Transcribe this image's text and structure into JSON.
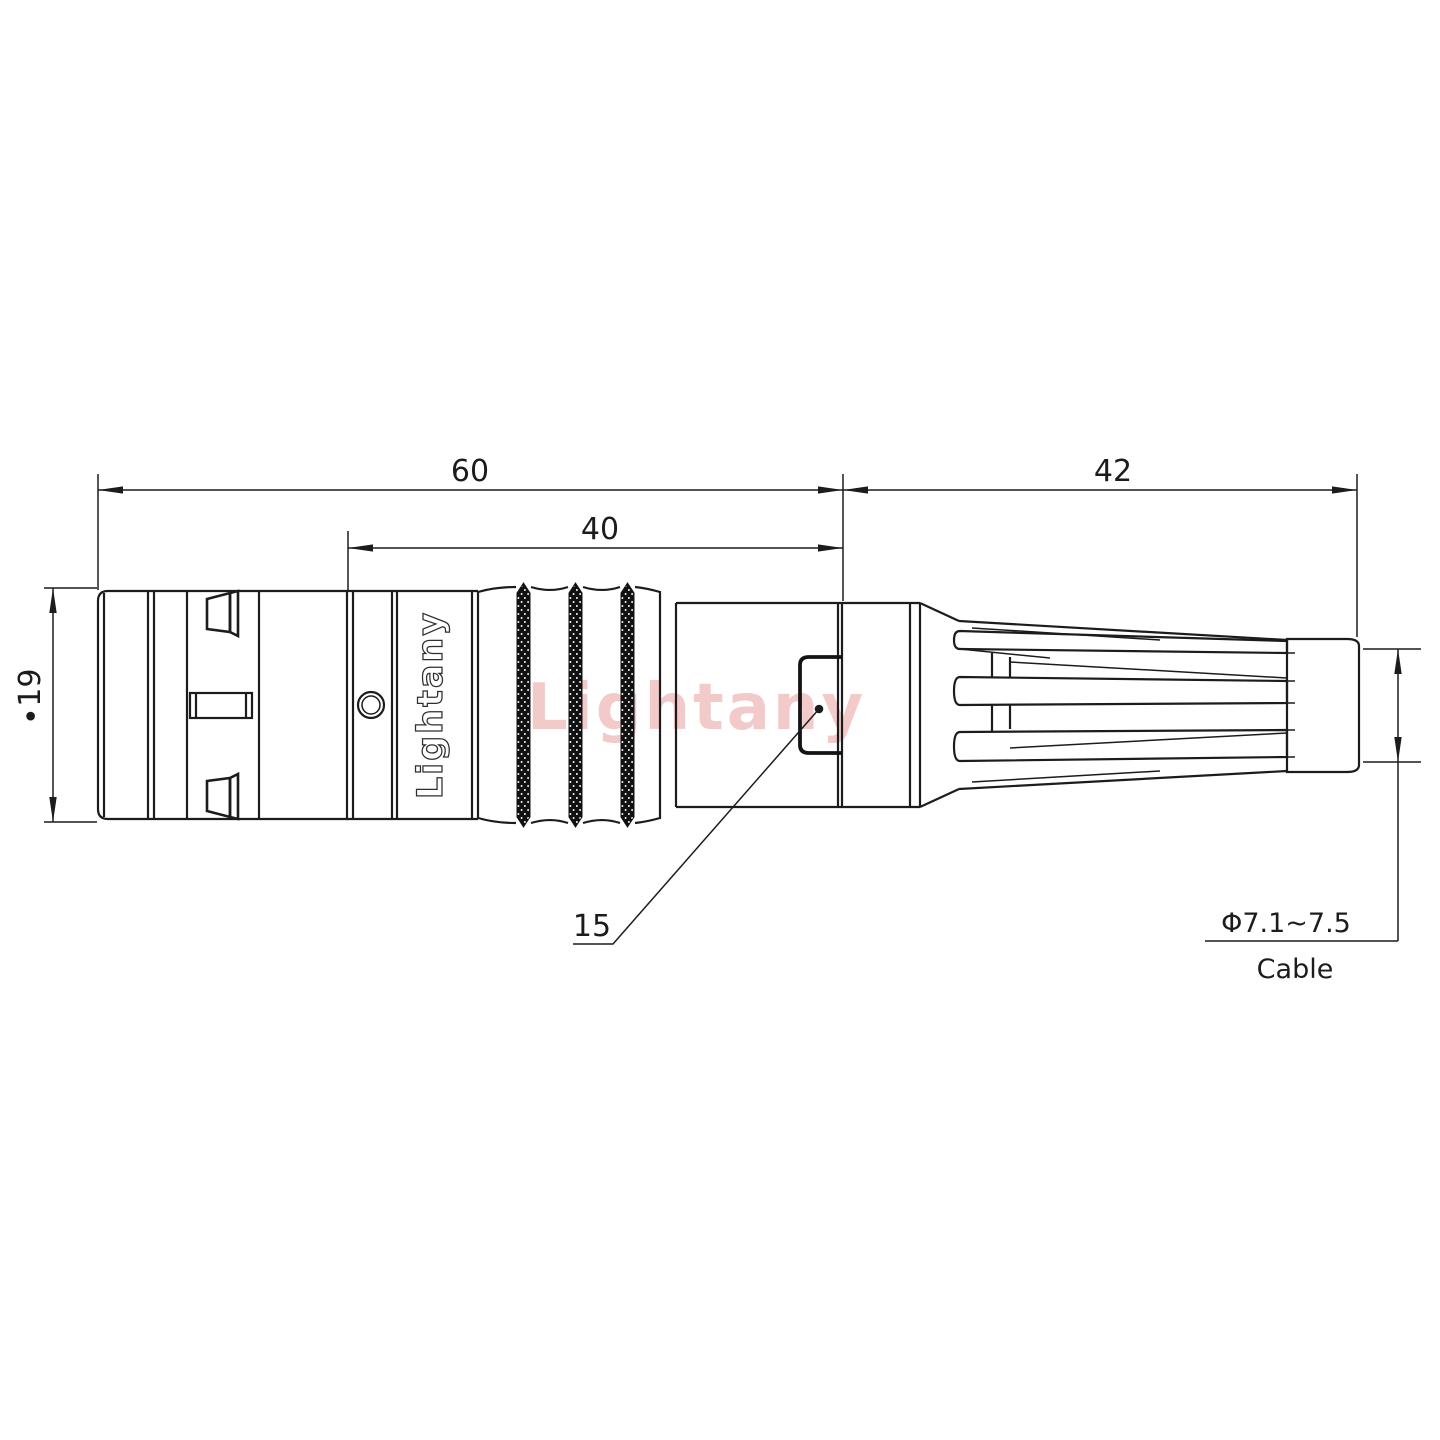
{
  "drawing_title": "connector-outline-drawing",
  "watermark": {
    "text": "Lightany",
    "color": "#f3caca"
  },
  "engraving": {
    "text": "Lightany",
    "outline_color": "#2e2e2e"
  },
  "dimensions": {
    "overall_length": "60",
    "front_section_length": "40",
    "boot_length": "42",
    "shell_diameter": "∙19",
    "window_width": "15",
    "cable_diameter_range": "Φ7.1~7.5",
    "cable_label": "Cable"
  },
  "colors": {
    "line": "#1c1c1c",
    "background": "#ffffff",
    "knurl_fill": "#111111"
  }
}
